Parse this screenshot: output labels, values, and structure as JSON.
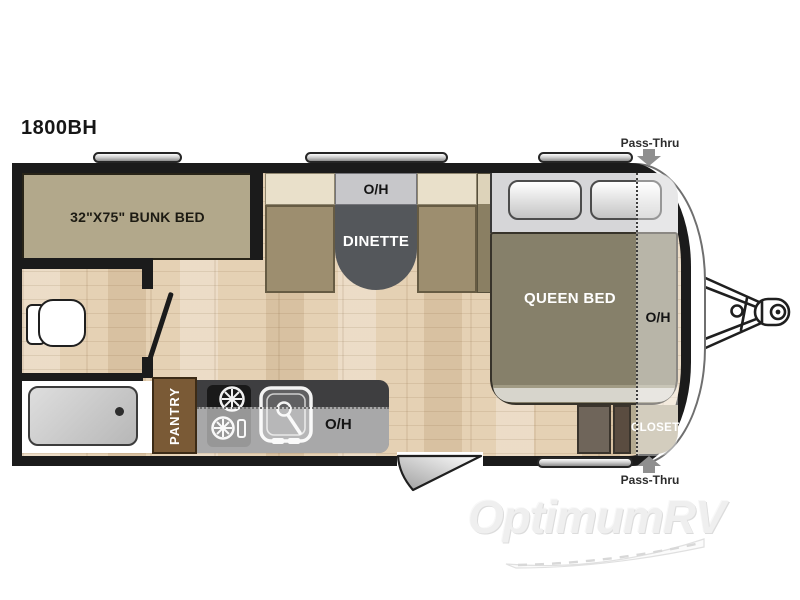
{
  "page": {
    "title": "1800BH",
    "watermark": "OptimumRV"
  },
  "floorplan": {
    "bunk_room": {
      "bunk_label": "32\"X75\" BUNK BED"
    },
    "dinette": {
      "oh_label": "O/H",
      "table_label": "DINETTE"
    },
    "kitchen": {
      "oh_label": "O/H",
      "pantry_label": "PANTRY"
    },
    "bedroom": {
      "bed_label": "QUEEN BED",
      "oh_label": "O/H",
      "closet_label": "CLOSET"
    },
    "annotations": {
      "pass_thru_top": "Pass-Thru",
      "pass_thru_bottom": "Pass-Thru"
    }
  },
  "colors": {
    "wall": "#1b1b1b",
    "floor_wood": "#e5d1b4",
    "bunk_bed": "#b2a88b",
    "bench_seat": "#9d8e6f",
    "bench_back": "#e9e0ca",
    "dinette_table": "#54575b",
    "overhead_cabinet": "#c7c7ca",
    "queen_bed": "#86806a",
    "headboard": "#d6d6d8",
    "pantry": "#7a5a36",
    "kitchen_counter": "#3e3e40",
    "closet": "#b4aa90",
    "pass_thru_arrow": "#8f8f8f"
  }
}
